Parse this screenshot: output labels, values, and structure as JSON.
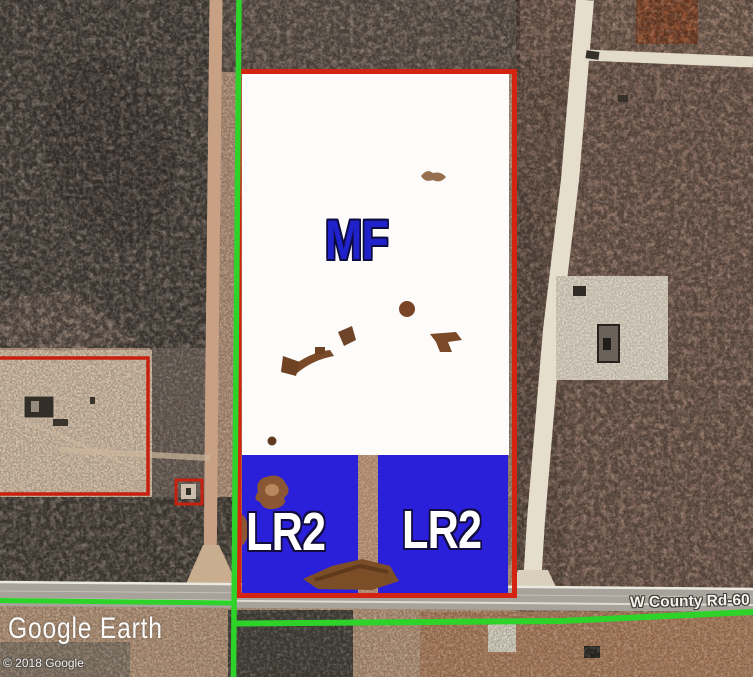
{
  "app": {
    "watermark": "Google Earth",
    "copyright": "© 2018 Google"
  },
  "map": {
    "road_label": "W County Rd-60",
    "zoning": {
      "mf_zone": {
        "label": "MF",
        "fill_color": "#fdfcfb",
        "label_color": "#2023cc"
      },
      "lr2_zone_left": {
        "label": "LR2"
      },
      "lr2_zone_right": {
        "label": "LR2"
      },
      "lr2_fill_color": "#2b20d9",
      "parcel_border_color": "#d42310",
      "section_line_color": "#2ed32a",
      "label_outline_color": "#120d3e"
    }
  }
}
